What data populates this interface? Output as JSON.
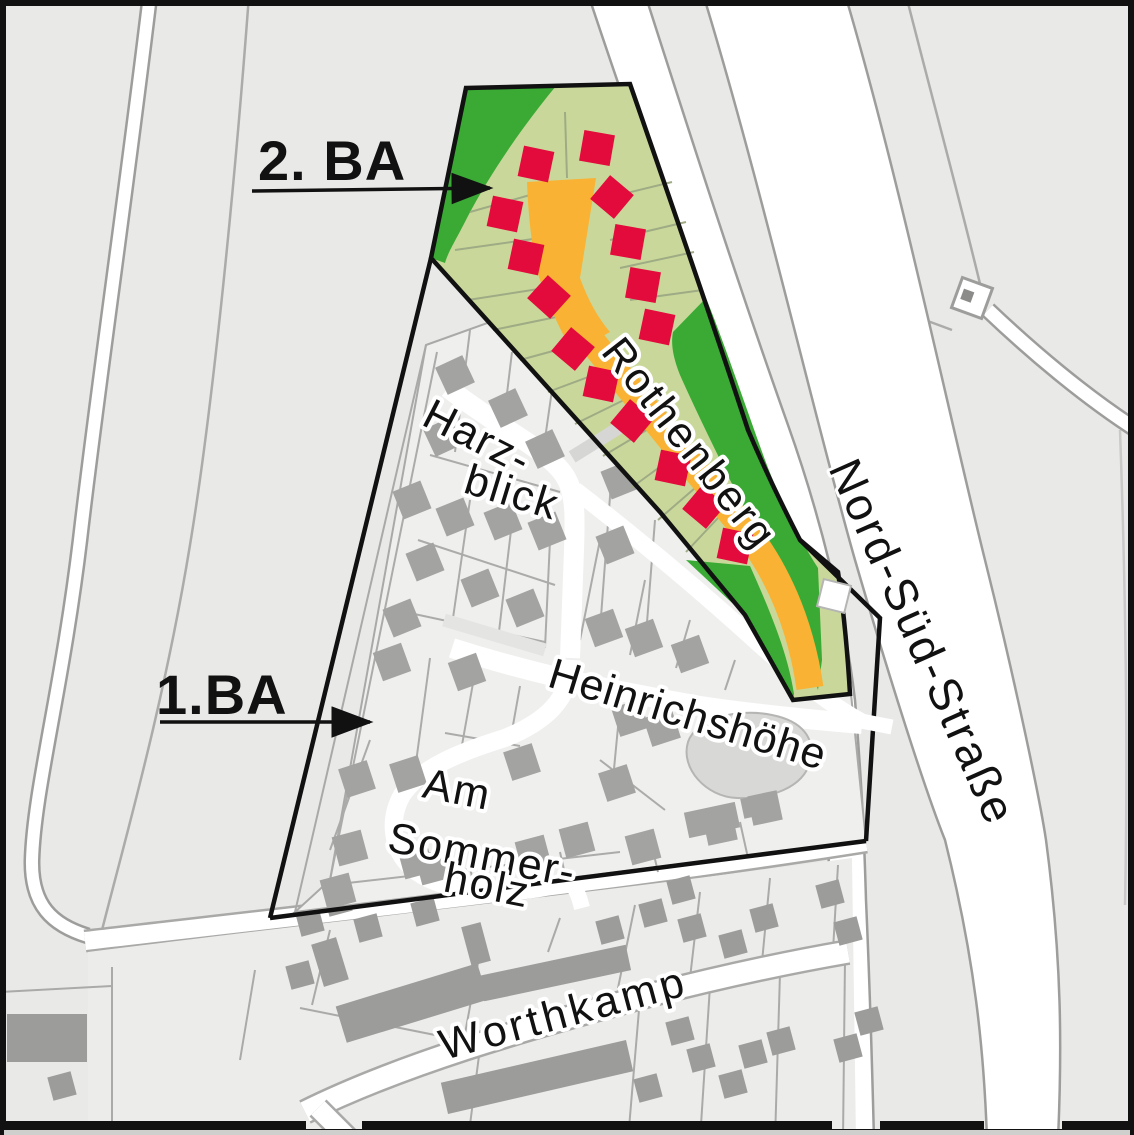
{
  "map_labels": {
    "phase_2": "2. BA",
    "phase_1": "1.BA",
    "streets": {
      "harzblick_1": "Harz-",
      "harzblick_2": "blick",
      "heinrichshoehe": "Heinrichshöhe",
      "am_sommerholz_1": "Am",
      "am_sommerholz_2": "Sommer-",
      "am_sommerholz_3": "holz",
      "worthkamp": "Worthkamp",
      "rothenberg": "Rothenberg",
      "nord_sued_strasse": "Nord-Süd-Straße"
    }
  },
  "legend_colors": {
    "green_belt": "#3aaa35",
    "building_parcel_green": "#c9d89a",
    "parcel_line_green": "#9fab84",
    "planned_road_orange": "#f9b233",
    "planned_house_red": "#e30a3c",
    "existing_house_gray": "#a3a3a2",
    "worthkamp_house_gray": "#9c9c9b",
    "field_gray": "#e9e9e8",
    "parcel_block_gray": "#efefee",
    "road_white": "#ffffff",
    "road_casing_gray": "#9d9d9c",
    "boundary_black": "#111111"
  },
  "map_data": {
    "planned_houses_2ba": [
      [
        536,
        164,
        12
      ],
      [
        597,
        148,
        10
      ],
      [
        505,
        214,
        12
      ],
      [
        612,
        197,
        40
      ],
      [
        526,
        257,
        12
      ],
      [
        628,
        242,
        10
      ],
      [
        549,
        297,
        42
      ],
      [
        643,
        285,
        10
      ],
      [
        657,
        327,
        12
      ],
      [
        573,
        349,
        40
      ],
      [
        601,
        384,
        12
      ],
      [
        632,
        421,
        40
      ],
      [
        673,
        468,
        12
      ],
      [
        704,
        507,
        40
      ],
      [
        735,
        546,
        12
      ]
    ],
    "existing_houses_1ba": [
      [
        455,
        375,
        -25
      ],
      [
        508,
        408,
        -25
      ],
      [
        443,
        437,
        -25
      ],
      [
        545,
        449,
        -25
      ],
      [
        412,
        500,
        -22
      ],
      [
        455,
        517,
        -22
      ],
      [
        503,
        521,
        -22
      ],
      [
        547,
        531,
        -22
      ],
      [
        615,
        545,
        -22
      ],
      [
        620,
        480,
        -22
      ],
      [
        425,
        562,
        -22
      ],
      [
        480,
        588,
        -22
      ],
      [
        525,
        608,
        -22
      ],
      [
        402,
        618,
        -22
      ],
      [
        604,
        628,
        -20
      ],
      [
        644,
        638,
        -20
      ],
      [
        690,
        654,
        -20
      ],
      [
        392,
        662,
        -20
      ],
      [
        467,
        672,
        -20
      ],
      [
        522,
        762,
        -18
      ],
      [
        630,
        718,
        -18
      ],
      [
        662,
        728,
        -18
      ],
      [
        357,
        779,
        -18
      ],
      [
        408,
        774,
        -18
      ],
      [
        617,
        783,
        -18
      ],
      [
        350,
        848,
        -15
      ],
      [
        416,
        861,
        -15
      ],
      [
        338,
        891,
        -15
      ],
      [
        433,
        867,
        -15
      ],
      [
        533,
        853,
        -15
      ],
      [
        577,
        840,
        -15
      ],
      [
        643,
        847,
        -15
      ],
      [
        765,
        808,
        -12
      ],
      [
        720,
        828,
        -12
      ]
    ],
    "worthkamp_small_buildings": [
      [
        310,
        922
      ],
      [
        338,
        902
      ],
      [
        368,
        928
      ],
      [
        425,
        912
      ],
      [
        300,
        975
      ],
      [
        610,
        930
      ],
      [
        653,
        913
      ],
      [
        681,
        890
      ],
      [
        692,
        928
      ],
      [
        733,
        944
      ],
      [
        764,
        918
      ],
      [
        830,
        894
      ],
      [
        848,
        931
      ],
      [
        680,
        1031
      ],
      [
        701,
        1058
      ],
      [
        648,
        1088
      ],
      [
        733,
        1084
      ],
      [
        753,
        1054
      ],
      [
        781,
        1041
      ],
      [
        848,
        1048
      ],
      [
        869,
        1021
      ],
      [
        62,
        1086
      ]
    ],
    "worthkamp_terraces": [
      [
        412,
        1003,
        148,
        38,
        -17
      ],
      [
        555,
        973,
        150,
        26,
        -12
      ],
      [
        537,
        1077,
        190,
        32,
        -13
      ],
      [
        47,
        1038,
        80,
        48,
        0
      ],
      [
        330,
        962,
        26,
        44,
        -17
      ],
      [
        476,
        944,
        20,
        40,
        -15
      ]
    ],
    "misc_buildings_1ba": [
      [
        712,
        820,
        52,
        26,
        -12
      ],
      [
        756,
        806,
        28,
        20,
        -12
      ]
    ]
  }
}
